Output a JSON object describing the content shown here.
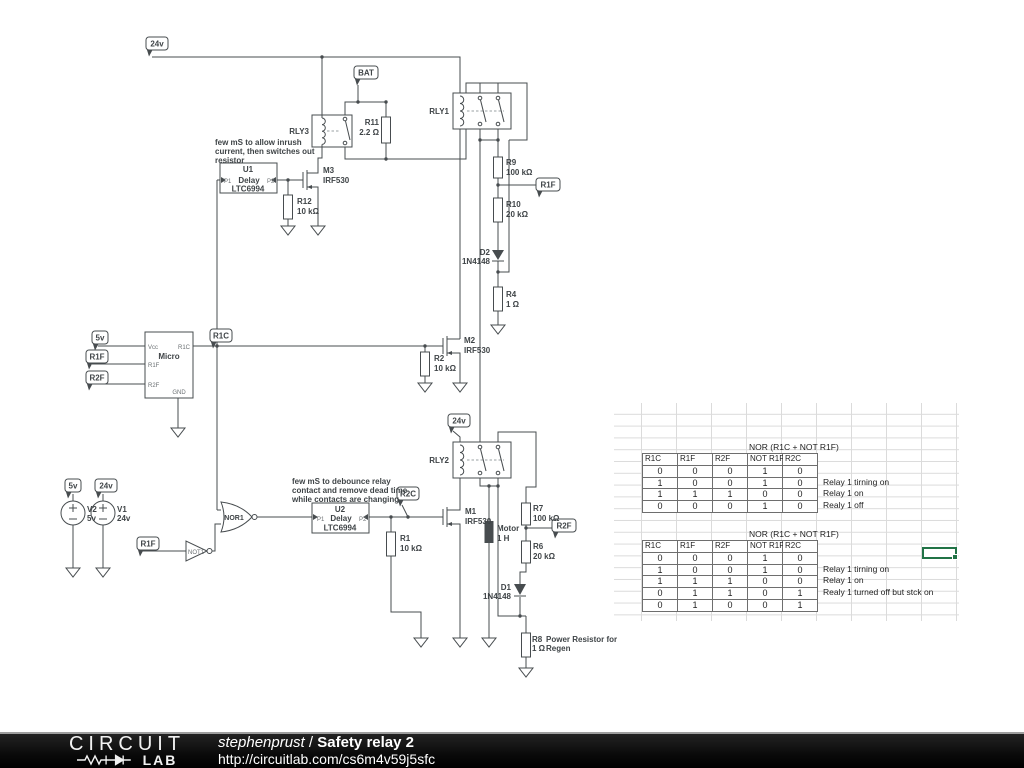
{
  "schematic": {
    "labels": {
      "flag_24v_top": "24v",
      "flag_bat": "BAT",
      "rly3": "RLY3",
      "r11_name": "R11",
      "r11_value": "2.2 Ω",
      "note_u1_l1": "few mS to allow inrush",
      "note_u1_l2": "current, then switches out",
      "note_u1_l3": "resistor",
      "u1_name": "U1",
      "u1_p1": "P1",
      "u1_delay": "Delay",
      "u1_p2": "P2",
      "u1_part": "LTC6994",
      "m3_name": "M3",
      "m3_part": "IRF530",
      "r12_name": "R12",
      "r12_value": "10 kΩ",
      "rly1": "RLY1",
      "r9_name": "R9",
      "r9_value": "100 kΩ",
      "flag_r1f_right": "R1F",
      "r10_name": "R10",
      "r10_value": "20 kΩ",
      "d2_name": "D2",
      "d2_part": "1N4148",
      "r4_name": "R4",
      "r4_value": "1 Ω",
      "flag_5v_micro": "5v",
      "flag_r1f_micro": "R1F",
      "flag_r2f_micro": "R2F",
      "flag_r1c": "R1C",
      "micro_name": "Micro",
      "micro_vcc": "Vcc",
      "micro_r1f": "R1F",
      "micro_r2f": "R2F",
      "micro_r1c": "R1C",
      "micro_gnd": "GND",
      "m2_name": "M2",
      "m2_part": "IRF530",
      "r2_name": "R2",
      "r2_value": "10 kΩ",
      "flag_24v_rly2": "24v",
      "rly2": "RLY2",
      "motor_name": "Motor",
      "motor_value": "1 H",
      "r7_name": "R7",
      "r7_value": "100 kΩ",
      "flag_r2f_right": "R2F",
      "r6_name": "R6",
      "r6_value": "20 kΩ",
      "m1_name": "M1",
      "m1_part": "IRF530",
      "r1_name": "R1",
      "r1_value": "10 kΩ",
      "flag_r2c": "R2C",
      "flag_5v_src": "5v",
      "flag_24v_src": "24v",
      "v2_name": "V2",
      "v2_value": "5v",
      "v1_name": "V1",
      "v1_value": "24v",
      "nor1": "NOR1",
      "not1": "NOT1",
      "flag_r1f_not": "R1F",
      "note_u2_l1": "few mS to debounce relay",
      "note_u2_l2": "contact and remove dead time",
      "note_u2_l3": "while contacts are changing",
      "u2_name": "U2",
      "u2_p1": "P1",
      "u2_delay": "Delay",
      "u2_p2": "P2",
      "u2_part": "LTC6994",
      "d1_name": "D1",
      "d1_part": "1N4148",
      "r8_name": "R8",
      "r8_value": "1 Ω",
      "r8_note_l1": "Power Resistor for",
      "r8_note_l2": "Regen"
    }
  },
  "sheet": {
    "nor_note": "NOR (R1C + NOT R1F)",
    "table1": {
      "headers": [
        "R1C",
        "R1F",
        "R2F",
        "NOT R1F",
        "R2C"
      ],
      "rows": [
        [
          "0",
          "0",
          "0",
          "1",
          "0"
        ],
        [
          "1",
          "0",
          "0",
          "1",
          "0"
        ],
        [
          "1",
          "1",
          "1",
          "0",
          "0"
        ],
        [
          "0",
          "0",
          "0",
          "1",
          "0"
        ]
      ],
      "annotations": [
        "",
        "Relay 1 tirning on",
        "Relay 1 on",
        "Realy 1 off"
      ]
    },
    "table2": {
      "headers": [
        "R1C",
        "R1F",
        "R2F",
        "NOT R1F",
        "R2C"
      ],
      "rows": [
        [
          "0",
          "0",
          "0",
          "1",
          "0"
        ],
        [
          "1",
          "0",
          "0",
          "1",
          "0"
        ],
        [
          "1",
          "1",
          "1",
          "0",
          "0"
        ],
        [
          "0",
          "1",
          "1",
          "0",
          "1"
        ],
        [
          "0",
          "1",
          "0",
          "0",
          "1"
        ]
      ],
      "annotations": [
        "",
        "Relay 1 tirning on",
        "Relay 1 on",
        "Realy 1 turned off but stck on",
        ""
      ]
    },
    "selection_color": "#217346"
  },
  "footer": {
    "brand_top": "CIRCUIT",
    "brand_bottom": "LAB",
    "author": "stephenprust",
    "sep": " / ",
    "title": "Safety relay 2",
    "url": "http://circuitlab.com/cs6m4v59j5sfc"
  }
}
